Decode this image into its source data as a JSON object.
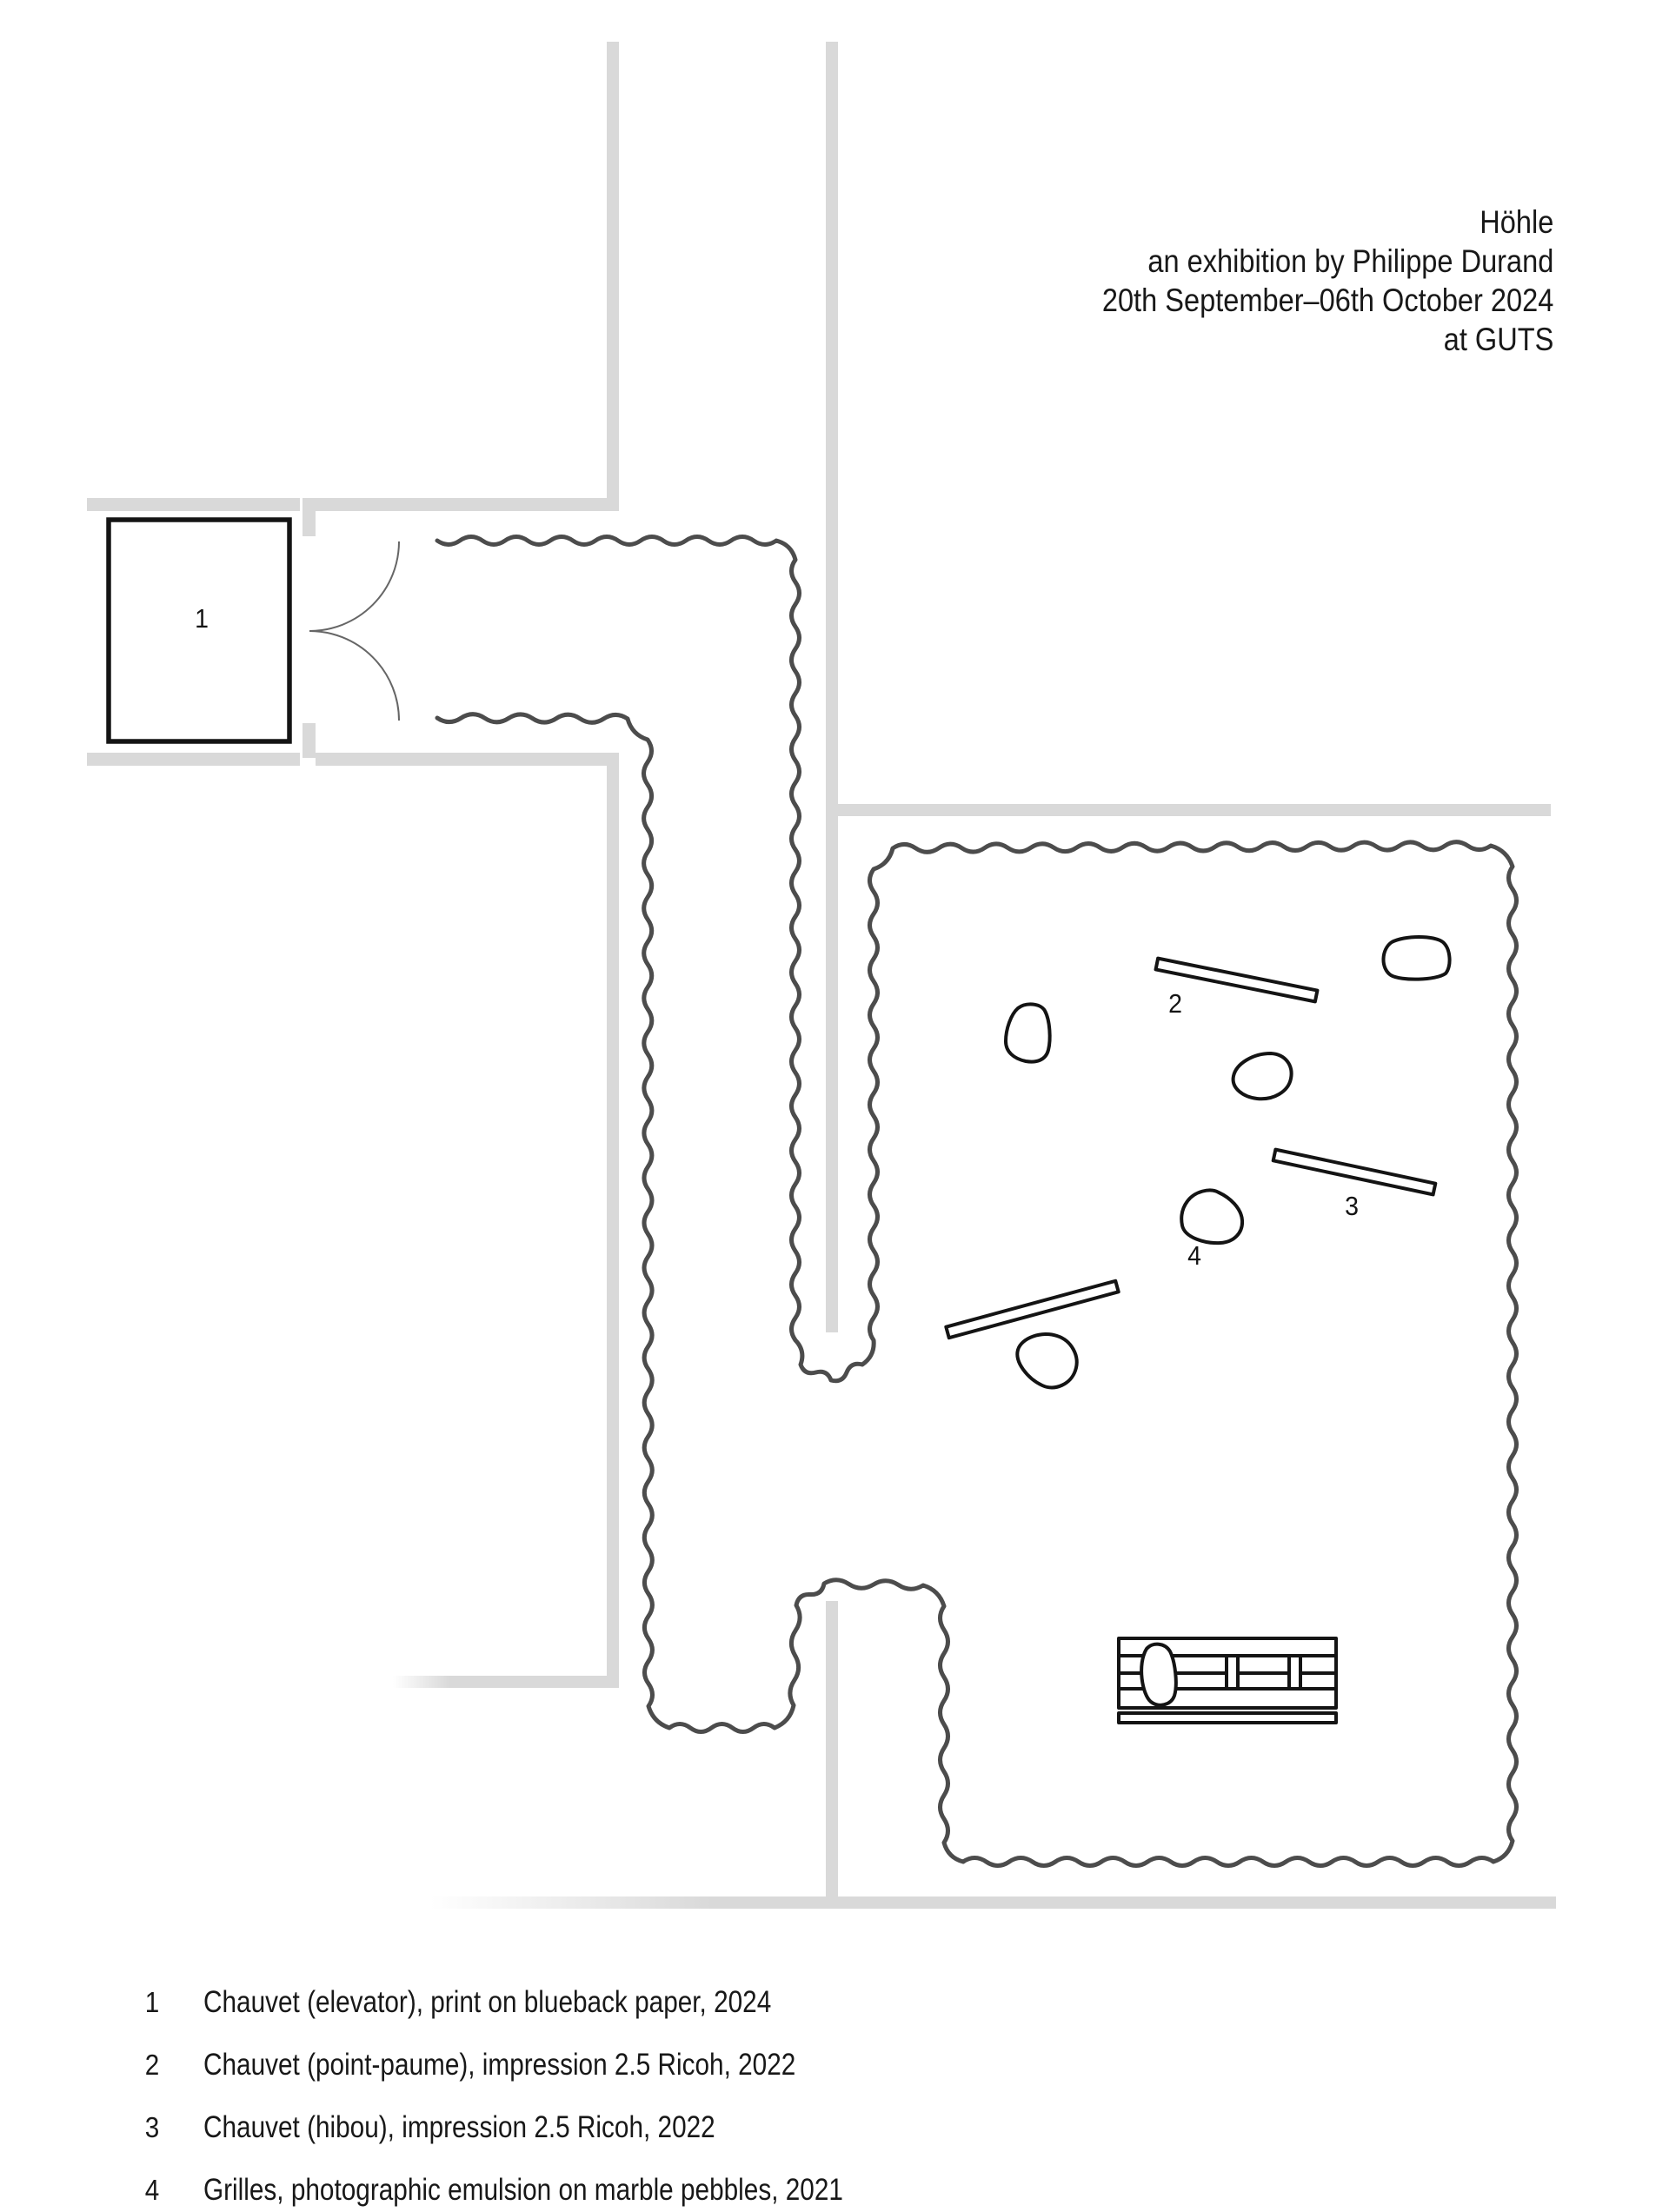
{
  "header": {
    "title_lines": [
      "Höhle",
      "an exhibition by Philippe Durand",
      "20th September–06th October 2024",
      "at GUTS"
    ]
  },
  "map_labels": {
    "l1": "1",
    "l2": "2",
    "l3": "3",
    "l4": "4"
  },
  "legend": {
    "items": [
      {
        "num": "1",
        "text": "Chauvet (elevator), print on blueback paper, 2024"
      },
      {
        "num": "2",
        "text": "Chauvet (point-paume), impression 2.5 Ricoh, 2022"
      },
      {
        "num": "3",
        "text": "Chauvet (hibou), impression 2.5 Ricoh, 2022"
      },
      {
        "num": "4",
        "text": "Grilles, photographic emulsion on marble pebbles, 2021"
      }
    ]
  },
  "colors": {
    "background": "#ffffff",
    "wall_gray": "#d9d9d9",
    "cave_line": "#4c4c4c",
    "ink": "#141414",
    "text": "#181818"
  }
}
